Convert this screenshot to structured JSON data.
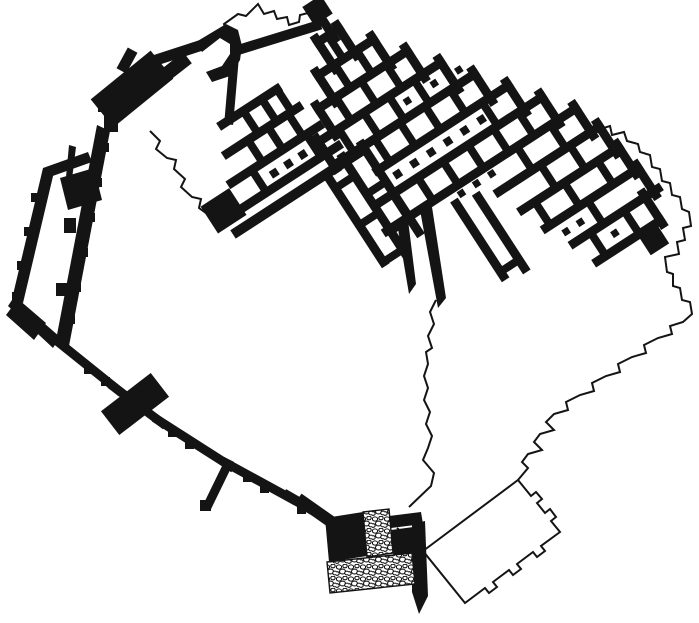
{
  "canvas": {
    "width": 699,
    "height": 623,
    "background": "#ffffff",
    "ink": "#141414",
    "outline_width": 2
  },
  "plan": {
    "description_names": [
      "building-complex",
      "casemate-enclosure",
      "west-rampart",
      "south-gate",
      "annex-outline",
      "restored-circuit-outline"
    ],
    "complex": {
      "pivot": [
        322,
        30
      ],
      "angle": -33,
      "walls": [
        [
          -10,
          8,
          15,
          8,
          9
        ],
        [
          -28,
          36,
          38,
          36,
          9
        ],
        [
          -46,
          64,
          60,
          64,
          9
        ],
        [
          -64,
          92,
          82,
          92,
          9
        ],
        [
          -64,
          120,
          104,
          120,
          9
        ],
        [
          -30,
          148,
          126,
          148,
          9
        ],
        [
          -45,
          176,
          148,
          176,
          9
        ],
        [
          -55,
          204,
          170,
          204,
          9
        ],
        [
          60,
          232,
          180,
          232,
          9
        ],
        [
          70,
          260,
          185,
          260,
          9
        ],
        [
          80,
          288,
          190,
          288,
          9
        ],
        [
          95,
          316,
          195,
          316,
          9
        ],
        [
          105,
          344,
          180,
          344,
          9
        ],
        [
          15,
          4,
          15,
          40,
          9
        ],
        [
          38,
          32,
          38,
          68,
          9
        ],
        [
          60,
          60,
          60,
          96,
          9
        ],
        [
          82,
          88,
          82,
          124,
          9
        ],
        [
          104,
          116,
          104,
          152,
          9
        ],
        [
          126,
          144,
          126,
          180,
          9
        ],
        [
          148,
          172,
          148,
          208,
          9
        ],
        [
          170,
          200,
          170,
          236,
          9
        ],
        [
          180,
          228,
          180,
          264,
          9
        ],
        [
          185,
          256,
          185,
          292,
          9
        ],
        [
          190,
          284,
          190,
          320,
          9
        ],
        [
          180,
          312,
          180,
          348,
          9
        ],
        [
          -10,
          4,
          -10,
          40,
          9
        ],
        [
          -28,
          32,
          -28,
          68,
          9
        ],
        [
          -46,
          60,
          -46,
          96,
          9
        ],
        [
          -64,
          88,
          -64,
          124,
          9
        ],
        [
          2,
          8,
          2,
          36,
          8
        ],
        [
          -8,
          36,
          -8,
          64,
          8
        ],
        [
          18,
          36,
          18,
          64,
          8
        ],
        [
          -25,
          64,
          -25,
          92,
          8
        ],
        [
          5,
          64,
          5,
          92,
          8
        ],
        [
          35,
          64,
          35,
          92,
          8
        ],
        [
          -40,
          92,
          -40,
          120,
          8
        ],
        [
          -10,
          92,
          -10,
          120,
          8
        ],
        [
          20,
          92,
          20,
          120,
          8
        ],
        [
          50,
          92,
          50,
          120,
          8
        ],
        [
          -15,
          120,
          -15,
          148,
          8
        ],
        [
          15,
          120,
          15,
          148,
          8
        ],
        [
          45,
          120,
          45,
          148,
          8
        ],
        [
          75,
          120,
          75,
          148,
          8
        ],
        [
          95,
          148,
          95,
          176,
          8
        ],
        [
          -30,
          176,
          -30,
          204,
          8
        ],
        [
          0,
          176,
          0,
          204,
          8
        ],
        [
          30,
          176,
          30,
          204,
          8
        ],
        [
          60,
          176,
          60,
          204,
          8
        ],
        [
          90,
          176,
          90,
          204,
          8
        ],
        [
          120,
          176,
          120,
          204,
          8
        ],
        [
          100,
          204,
          100,
          232,
          8
        ],
        [
          140,
          204,
          140,
          232,
          8
        ],
        [
          110,
          232,
          110,
          260,
          8
        ],
        [
          145,
          232,
          145,
          260,
          8
        ],
        [
          85,
          260,
          85,
          288,
          8
        ],
        [
          120,
          260,
          120,
          288,
          8
        ],
        [
          160,
          260,
          160,
          288,
          8
        ],
        [
          130,
          288,
          130,
          316,
          8
        ],
        [
          115,
          316,
          115,
          344,
          8
        ],
        [
          155,
          316,
          155,
          344,
          8
        ],
        [
          6,
          -9,
          6,
          14,
          9
        ],
        [
          -135,
          25,
          -70,
          25,
          9
        ],
        [
          -147,
          52,
          -62,
          52,
          9
        ],
        [
          -159,
          79,
          -55,
          79,
          9
        ],
        [
          -171,
          106,
          -50,
          106,
          9
        ],
        [
          -181,
          123,
          -35,
          123,
          10
        ],
        [
          -110,
          25,
          -110,
          52,
          8
        ],
        [
          -88,
          25,
          -88,
          52,
          8
        ],
        [
          -70,
          25,
          -70,
          52,
          8
        ],
        [
          -122,
          52,
          -122,
          79,
          8
        ],
        [
          -98,
          52,
          -98,
          79,
          8
        ],
        [
          -74,
          52,
          -74,
          79,
          8
        ],
        [
          -135,
          79,
          -135,
          106,
          8
        ],
        [
          -70,
          79,
          -70,
          106,
          8
        ],
        [
          -75,
          123,
          -75,
          228,
          9
        ],
        [
          -52,
          118,
          -52,
          232,
          9
        ],
        [
          -29,
          118,
          -29,
          222,
          9
        ],
        [
          -75,
          140,
          -52,
          140,
          8
        ],
        [
          -52,
          162,
          -29,
          162,
          8
        ],
        [
          -75,
          184,
          -52,
          184,
          8
        ],
        [
          -52,
          206,
          -29,
          206,
          8
        ],
        [
          -75,
          228,
          -52,
          228,
          8
        ],
        [
          18,
          219,
          18,
          305,
          9
        ],
        [
          40,
          225,
          40,
          310,
          9
        ],
        [
          18,
          300,
          40,
          300,
          8
        ]
      ],
      "blocks": [
        [
          -4,
          -30,
          22,
          22
        ],
        [
          -198,
          82,
          34,
          32
        ],
        [
          153,
          348,
          22,
          20
        ]
      ],
      "dots": [
        [
          -15,
          162,
          8
        ],
        [
          5,
          162,
          8
        ],
        [
          25,
          162,
          8
        ],
        [
          45,
          162,
          8
        ],
        [
          65,
          162,
          8
        ],
        [
          85,
          162,
          8
        ],
        [
          -118,
          94,
          8
        ],
        [
          -101,
          94,
          8
        ],
        [
          -84,
          94,
          8
        ],
        [
          33,
          106,
          7
        ],
        [
          65,
          106,
          7
        ],
        [
          93,
          108,
          7
        ],
        [
          28,
          213,
          7
        ],
        [
          46,
          213,
          7
        ],
        [
          64,
          213,
          7
        ],
        [
          95,
          302,
          7
        ],
        [
          112,
          302,
          7
        ],
        [
          135,
          330,
          7
        ]
      ]
    },
    "global_walls": [
      [
        238,
        50,
        316,
        26,
        10
      ],
      [
        229,
        120,
        234,
        62,
        9
      ],
      [
        150,
        62,
        196,
        47,
        11
      ],
      [
        164,
        76,
        182,
        62,
        14
      ],
      [
        116,
        102,
        148,
        76,
        36
      ],
      [
        124,
        66,
        130,
        55,
        11
      ],
      [
        57,
        341,
        118,
        390,
        9
      ],
      [
        114,
        387,
        162,
        423,
        9
      ],
      [
        158,
        420,
        230,
        466,
        9
      ],
      [
        226,
        463,
        292,
        499,
        9
      ],
      [
        288,
        496,
        328,
        519,
        10
      ],
      [
        122,
        414,
        148,
        394,
        30
      ],
      [
        228,
        464,
        208,
        505,
        9
      ],
      [
        303,
        502,
        330,
        521,
        12
      ]
    ],
    "global_blocks": [
      [
        98,
        97,
        16,
        15
      ],
      [
        104,
        116,
        14,
        16
      ],
      [
        100,
        143,
        9,
        9
      ],
      [
        93,
        178,
        9,
        9
      ],
      [
        86,
        213,
        9,
        9
      ],
      [
        79,
        248,
        9,
        9
      ],
      [
        72,
        283,
        9,
        9
      ],
      [
        66,
        315,
        9,
        9
      ],
      [
        31,
        193,
        9,
        9
      ],
      [
        24,
        227,
        9,
        9
      ],
      [
        17,
        261,
        9,
        9
      ],
      [
        12,
        292,
        8,
        8
      ],
      [
        64,
        218,
        12,
        15
      ],
      [
        56,
        283,
        11,
        13
      ],
      [
        84,
        365,
        9,
        9
      ],
      [
        101,
        377,
        9,
        9
      ],
      [
        168,
        428,
        9,
        9
      ],
      [
        185,
        440,
        9,
        9
      ],
      [
        243,
        473,
        9,
        9
      ],
      [
        260,
        484,
        9,
        9
      ],
      [
        297,
        505,
        9,
        9
      ],
      [
        200,
        500,
        11,
        11
      ]
    ],
    "polygons": [
      {
        "name": "casemate-east-wall",
        "fill": "ink",
        "points": [
          [
            97,
            125
          ],
          [
            110,
            131
          ],
          [
            69,
            346
          ],
          [
            56,
            340
          ]
        ]
      },
      {
        "name": "casemate-west-wall",
        "fill": "ink",
        "points": [
          [
            43,
            168
          ],
          [
            54,
            172
          ],
          [
            23,
            303
          ],
          [
            12,
            299
          ]
        ]
      },
      {
        "name": "casemate-north-wall",
        "fill": "ink",
        "points": [
          [
            43,
            168
          ],
          [
            88,
            152
          ],
          [
            92,
            162
          ],
          [
            47,
            178
          ]
        ]
      },
      {
        "name": "casemate-cross-block",
        "fill": "ink",
        "points": [
          [
            60,
            178
          ],
          [
            94,
            168
          ],
          [
            102,
            200
          ],
          [
            68,
            210
          ]
        ]
      },
      {
        "name": "casemate-south-wall",
        "fill": "ink",
        "points": [
          [
            14,
            297
          ],
          [
            60,
            337
          ],
          [
            53,
            348
          ],
          [
            8,
            306
          ]
        ]
      },
      {
        "name": "casemate-corner-block",
        "fill": "ink",
        "points": [
          [
            18,
            299
          ],
          [
            46,
            323
          ],
          [
            34,
            340
          ],
          [
            6,
            315
          ]
        ]
      },
      {
        "name": "wall-spike",
        "fill": "ink",
        "points": [
          [
            69,
            145
          ],
          [
            76,
            147
          ],
          [
            72,
            179
          ],
          [
            66,
            177
          ]
        ]
      },
      {
        "name": "northwest-hook-building",
        "fill": "ink",
        "points": [
          [
            196,
            42
          ],
          [
            226,
            24
          ],
          [
            238,
            30
          ],
          [
            242,
            46
          ],
          [
            240,
            60
          ],
          [
            230,
            76
          ],
          [
            212,
            82
          ],
          [
            206,
            72
          ],
          [
            222,
            66
          ],
          [
            230,
            54
          ],
          [
            230,
            44
          ],
          [
            220,
            38
          ],
          [
            202,
            52
          ]
        ]
      },
      {
        "name": "finger-wall-a",
        "fill": "ink",
        "points": [
          [
            397,
            223
          ],
          [
            408,
            220
          ],
          [
            416,
            284
          ],
          [
            409,
            294
          ]
        ]
      },
      {
        "name": "finger-wall-b",
        "fill": "ink",
        "points": [
          [
            420,
            210
          ],
          [
            432,
            207
          ],
          [
            446,
            298
          ],
          [
            438,
            308
          ]
        ]
      },
      {
        "name": "gate-left-tower",
        "fill": "ink",
        "points": [
          [
            325,
            518
          ],
          [
            363,
            512
          ],
          [
            367,
            556
          ],
          [
            329,
            562
          ]
        ]
      },
      {
        "name": "gate-right-bar",
        "fill": "ink",
        "points": [
          [
            389,
            516
          ],
          [
            421,
            512
          ],
          [
            423,
            524
          ],
          [
            391,
            528
          ]
        ]
      },
      {
        "name": "gate-right-tower",
        "fill": "ink",
        "points": [
          [
            391,
            530
          ],
          [
            421,
            526
          ],
          [
            424,
            558
          ],
          [
            394,
            562
          ]
        ]
      },
      {
        "name": "gate-right-band",
        "fill": "ink",
        "points": [
          [
            412,
            524
          ],
          [
            425,
            521
          ],
          [
            428,
            596
          ],
          [
            419,
            614
          ],
          [
            412,
            592
          ]
        ]
      },
      {
        "name": "gate-passage-cobbles",
        "fill": "cobble",
        "points": [
          [
            363,
            512
          ],
          [
            389,
            509
          ],
          [
            393,
            553
          ],
          [
            367,
            557
          ]
        ]
      },
      {
        "name": "gate-apron-cobbles",
        "fill": "cobble",
        "points": [
          [
            327,
            562
          ],
          [
            412,
            553
          ],
          [
            415,
            584
          ],
          [
            330,
            593
          ]
        ]
      }
    ],
    "outlines": [
      {
        "name": "circuit-northwest",
        "d": "M212,42 L226,30 L224,24 L238,14 L246,16 L258,4 L264,14 L274,11 L277,19 L287,17 L289,25 L299,22 L300,15 L308,13"
      },
      {
        "name": "circuit-east-south",
        "d": "M597,130 L610,126 L612,135 L624,132 L627,141 L638,144 L640,152 L650,155 L652,167 L660,169 L662,181 L670,183 L672,195 L680,197 L682,209 L689,212 L691,226 L683,228 L685,240 L677,242 L679,254 L665,257 L667,272 L673,274 L673,286 L680,288 L682,300 L690,302 L692,314 L683,322 L670,326 L672,334 L658,338 L644,345 L646,353 L632,357 L618,364 L620,372 L606,376 L592,383 L594,391 L580,395 L566,402 L568,410 L554,414 L546,422 L554,430 L540,434 L534,442 L542,450 L528,454 L522,462 L528,468 L518,480"
      },
      {
        "name": "annex-building-outline",
        "d": "M518,480 L531,496 L536,492 L542,499 L537,503 L545,513 L550,509 L556,517 L551,521 L560,532 L541,546 L545,551 L537,557 L533,552 L517,564 L521,569 L513,575 L509,570 L493,582 L497,587 L489,593 L485,588 L465,603 L423,551 Z"
      },
      {
        "name": "annex-to-gate-line",
        "d": "M423,551 L397,528"
      },
      {
        "name": "excavation-boundary-southeast",
        "d": "M436,300 L430,312 L434,324 L428,336 L432,348 L426,352 L428,364 L424,376 L428,388 L424,400 L430,412 L426,424 L432,436 L428,448 L423,460 L434,473 L431,486 L409,507"
      },
      {
        "name": "excavation-boundary-northwest",
        "d": "M150,131 L160,141 L156,149 L167,158 L176,160 L174,169 L185,179 L181,187 L192,197 L201,199 L199,208 L210,216 L218,212"
      }
    ]
  }
}
